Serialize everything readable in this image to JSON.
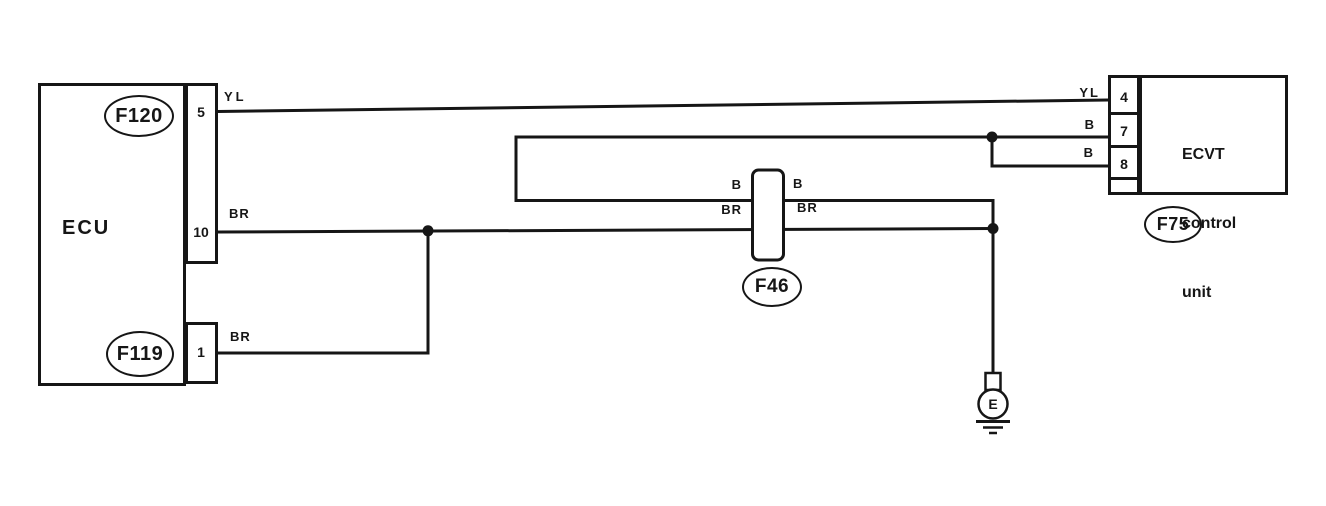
{
  "colors": {
    "line": "#161616",
    "bg": "#ffffff"
  },
  "ecu": {
    "label": "ECU",
    "connector_top_id": "F120",
    "connector_bottom_id": "F119",
    "pin5": "5",
    "pin10": "10",
    "pin1": "1"
  },
  "ecvt": {
    "name_line1": "ECVT",
    "name_line2": "control",
    "name_line3": "unit",
    "connector_id": "F75",
    "pin4": "4",
    "pin7": "7",
    "pin8": "8"
  },
  "inline_connector": {
    "id": "F46",
    "label_b_left": "B",
    "label_b_right": "B",
    "label_br_left": "BR",
    "label_br_right": "BR"
  },
  "wire_labels": {
    "yl_at_ecu": "YL",
    "br_at_pin10": "BR",
    "br_at_pin1": "BR",
    "yl_at_ecvt": "YL",
    "b_at_pin7": "B",
    "b_at_pin8": "B"
  },
  "ground": {
    "label": "E"
  }
}
